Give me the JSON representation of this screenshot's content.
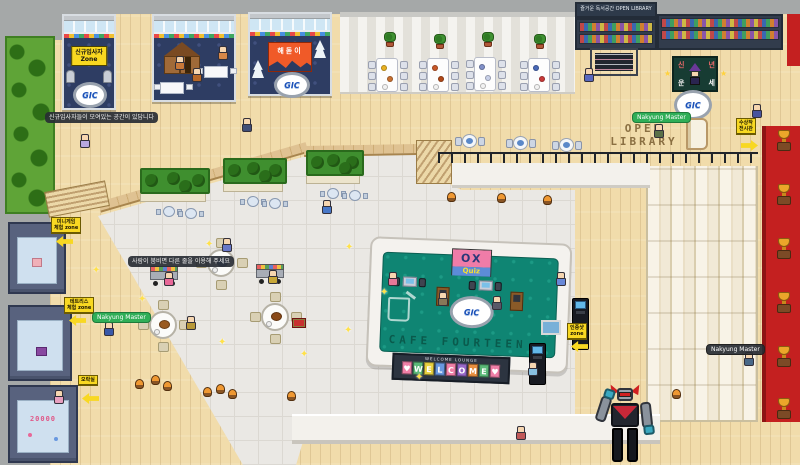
{
  "colors": {
    "accent_yellow": "#f8d822",
    "booth_navy": "#2e3d63",
    "cafe_teal": "#0f8573",
    "carpet_red": "#c42020",
    "nametag_green": "#2fae57"
  },
  "texts": {
    "new_zone_line1": "신규입사자",
    "new_zone_line2": "Zone",
    "sunrise": "해돋이",
    "fortune_l1": "신년",
    "fortune_l2": "운세",
    "shelf_header": "즐거운 독서공간 OPEN LIBRARY",
    "open_l1": "OPEN",
    "open_l2": "LIBRARY",
    "cafe_floor": "CAFE FOURTEEN",
    "ox": "OX",
    "quiz": "Quiz",
    "welcome_small": "WELCOME LOUNGE",
    "room3_score": "20000",
    "gic": "GIC"
  },
  "welcome": {
    "tiles": [
      "♥",
      "W",
      "E",
      "L",
      "C",
      "O",
      "M",
      "E",
      "♥"
    ],
    "tile_colors": [
      "#ef7fa7",
      "#5ab878",
      "#e8d040",
      "#6898e0",
      "#ef7fa7",
      "#9868c8",
      "#e89040",
      "#5ab878",
      "#ef7fa7"
    ]
  },
  "scene": {
    "planters": [
      {
        "x": 140,
        "y": 168,
        "w": 70
      },
      {
        "x": 223,
        "y": 158,
        "w": 64
      },
      {
        "x": 306,
        "y": 150,
        "w": 58
      }
    ],
    "mtables": [
      {
        "x": 156,
        "y": 206
      },
      {
        "x": 178,
        "y": 208
      },
      {
        "x": 240,
        "y": 196
      },
      {
        "x": 262,
        "y": 198
      },
      {
        "x": 320,
        "y": 188
      },
      {
        "x": 342,
        "y": 190
      }
    ],
    "dtables": [
      {
        "x": 455,
        "y": 134
      },
      {
        "x": 506,
        "y": 136
      },
      {
        "x": 552,
        "y": 138
      }
    ],
    "ttables": [
      {
        "x": 376,
        "y": 58,
        "f": [
          "#e8b020",
          "#c87030"
        ]
      },
      {
        "x": 427,
        "y": 58,
        "f": [
          "#c85828",
          "#b04818"
        ]
      },
      {
        "x": 474,
        "y": 57,
        "f": [
          "#8090c8",
          "#c8d0e8"
        ]
      },
      {
        "x": 528,
        "y": 58,
        "f": [
          "#4868b8",
          "#c83838"
        ]
      }
    ],
    "plants": [
      {
        "x": 384,
        "y": 32
      },
      {
        "x": 434,
        "y": 34
      },
      {
        "x": 482,
        "y": 32
      },
      {
        "x": 534,
        "y": 34
      }
    ],
    "rtables": [
      {
        "x": 196,
        "y": 238,
        "f": "#6888c8"
      },
      {
        "x": 138,
        "y": 300,
        "f": "#9a5a20"
      },
      {
        "x": 250,
        "y": 292,
        "f": "#8a4a18"
      }
    ],
    "carts": [
      {
        "x": 150,
        "y": 266
      },
      {
        "x": 256,
        "y": 264
      }
    ],
    "vends": [
      {
        "x": 572,
        "y": 298,
        "h": 52
      },
      {
        "x": 529,
        "y": 343,
        "h": 42
      }
    ],
    "gifts": [
      {
        "x": 292,
        "y": 318
      }
    ],
    "trophies": [
      {
        "x": 776,
        "y": 130
      },
      {
        "x": 776,
        "y": 184
      },
      {
        "x": 776,
        "y": 238
      },
      {
        "x": 776,
        "y": 292
      },
      {
        "x": 776,
        "y": 346
      },
      {
        "x": 776,
        "y": 398
      }
    ],
    "chars": [
      {
        "x": 80,
        "y": 134,
        "c": "#b8a8e0"
      },
      {
        "x": 104,
        "y": 322,
        "c": "#3858a8"
      },
      {
        "x": 242,
        "y": 118,
        "c": "#404e78"
      },
      {
        "x": 218,
        "y": 46,
        "c": "#d88848"
      },
      {
        "x": 175,
        "y": 56,
        "c": "#c87838"
      },
      {
        "x": 192,
        "y": 68,
        "c": "#b86828"
      },
      {
        "x": 584,
        "y": 68,
        "c": "#5868c0"
      },
      {
        "x": 752,
        "y": 104,
        "c": "#48549e"
      },
      {
        "x": 654,
        "y": 124,
        "c": "#5a7048"
      },
      {
        "x": 322,
        "y": 200,
        "c": "#4878c8"
      },
      {
        "x": 222,
        "y": 238,
        "c": "#6878c8"
      },
      {
        "x": 164,
        "y": 272,
        "c": "#e86898"
      },
      {
        "x": 268,
        "y": 270,
        "c": "#c8a838"
      },
      {
        "x": 186,
        "y": 316,
        "c": "#b89838"
      },
      {
        "x": 388,
        "y": 272,
        "c": "#e87898"
      },
      {
        "x": 556,
        "y": 272,
        "c": "#6888d8"
      },
      {
        "x": 438,
        "y": 292,
        "c": "#887858"
      },
      {
        "x": 492,
        "y": 296,
        "c": "#585868"
      },
      {
        "x": 528,
        "y": 362,
        "c": "#88c0e0"
      },
      {
        "x": 744,
        "y": 352,
        "c": "#486888"
      },
      {
        "x": 516,
        "y": 426,
        "c": "#c05858"
      },
      {
        "x": 54,
        "y": 390,
        "c": "#e8a0c0"
      }
    ],
    "stools": [
      {
        "x": 447,
        "y": 192
      },
      {
        "x": 497,
        "y": 193
      },
      {
        "x": 543,
        "y": 195
      },
      {
        "x": 135,
        "y": 379
      },
      {
        "x": 151,
        "y": 375
      },
      {
        "x": 163,
        "y": 381
      },
      {
        "x": 203,
        "y": 387
      },
      {
        "x": 216,
        "y": 384
      },
      {
        "x": 228,
        "y": 389
      },
      {
        "x": 287,
        "y": 391
      },
      {
        "x": 672,
        "y": 389
      }
    ],
    "sparkles": [
      {
        "x": 205,
        "y": 240
      },
      {
        "x": 345,
        "y": 243
      },
      {
        "x": 380,
        "y": 288
      },
      {
        "x": 218,
        "y": 338
      },
      {
        "x": 344,
        "y": 326
      },
      {
        "x": 138,
        "y": 295
      },
      {
        "x": 415,
        "y": 373
      },
      {
        "x": 92,
        "y": 266
      },
      {
        "x": 300,
        "y": 350
      }
    ],
    "stars": [
      {
        "x": 664,
        "y": 70
      },
      {
        "x": 720,
        "y": 70
      }
    ],
    "tooltips": [
      {
        "x": 45,
        "y": 112,
        "text": "신규입사자들이 모여있는 공간이 있답니다"
      },
      {
        "x": 128,
        "y": 256,
        "text": "사람이 붐비면 다른 줄을 이용해 주세요"
      }
    ],
    "nametags": [
      {
        "x": 92,
        "y": 312,
        "text": "Nakyung Master"
      },
      {
        "x": 632,
        "y": 112,
        "text": "Nakyung Master"
      },
      {
        "x": 706,
        "y": 344,
        "text": "Nakyung Master",
        "dark": true
      }
    ],
    "asigns": [
      {
        "x": 51,
        "y": 217,
        "lines": [
          "미니게임",
          "체험 zone"
        ]
      },
      {
        "x": 64,
        "y": 297,
        "lines": [
          "테트리스",
          "체험 zone"
        ]
      },
      {
        "x": 78,
        "y": 375,
        "lines": [
          "오락실"
        ]
      },
      {
        "x": 736,
        "y": 118,
        "lines": [
          "수상작",
          "전시관"
        ]
      },
      {
        "x": 567,
        "y": 323,
        "lines": [
          "인증샷",
          "zone"
        ]
      }
    ],
    "arrows": [
      {
        "x": 56,
        "y": 236,
        "d": "left"
      },
      {
        "x": 69,
        "y": 315,
        "d": "left"
      },
      {
        "x": 82,
        "y": 393,
        "d": "left"
      },
      {
        "x": 741,
        "y": 140,
        "d": "right"
      },
      {
        "x": 571,
        "y": 341,
        "d": "left"
      }
    ]
  }
}
